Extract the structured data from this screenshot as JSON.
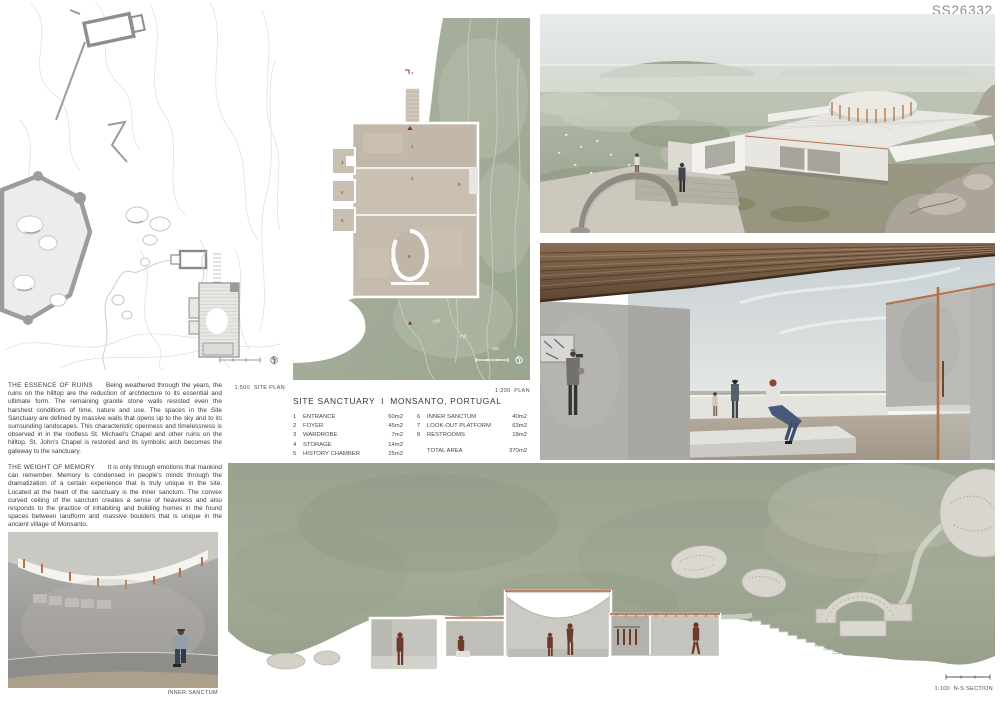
{
  "board_id": "SS26332",
  "title": "SITE SANCTUARY  I  MONSANTO, PORTUGAL",
  "theme": {
    "sage": "#a9b2a0",
    "sage-deep": "#97a18b",
    "stone-tan": "#c9c0b2",
    "concrete": "#b3b1ae",
    "wood": "#7d6147",
    "copper": "#b5714a",
    "figure-red": "#6e3a2c",
    "contour-gray": "#dedede",
    "caption-gray": "#4f4f4f"
  },
  "captions": {
    "site_plan": "1:500  SITE PLAN",
    "plan": "1:200  PLAN",
    "inner_sanctum": "INNER SANCTUM",
    "section": "1:100  N-S SECTION"
  },
  "essays": [
    {
      "heading": "THE ESSENCE OF RUINS",
      "body": "Being weathered through the years, the ruins on the hilltop are the reduction of architecture to its essential and ultimate form. The remaining granite stone walls resisted even the harshest conditions of time, nature and use.      The spaces in the Site Sanctuary are defined by massive walls that opens up to the sky and to its surrounding landscapes. This characteristic openness and timelessness is observed in in the roofless St. Michael's Chapel and other ruins on the hilltop. St. John's Chapel is restored and its symbolic arch becomes the gateway to the sanctuary."
    },
    {
      "heading": "THE WEIGHT OF MEMORY",
      "body": "It is only through emotions that mankind can remember. Memory is condensed in people's minds through the dramatization of a certain experience that is truly unique in the site. Located at the heart of the sanctuary is the inner sanctum. The convex curved ceiling of the sanctum creates a sense of heaviness and also responds to the practice of inhabiting and building homes in the found spaces between landform and massive boulders that is unique in the ancient village of Monsanto."
    }
  ],
  "program": {
    "left": [
      {
        "num": "1",
        "name": "ENTRANCE",
        "area": "60m2"
      },
      {
        "num": "2",
        "name": "FOYER",
        "area": "45m2"
      },
      {
        "num": "3",
        "name": "WARDROBE",
        "area": "7m2"
      },
      {
        "num": "4",
        "name": "STORAGE",
        "area": "14m2"
      },
      {
        "num": "5",
        "name": "HISTORY CHAMBER",
        "area": "25m2"
      }
    ],
    "right": [
      {
        "num": "6",
        "name": "INNER SANCTUM",
        "area": "40m2"
      },
      {
        "num": "7",
        "name": "LOOK-OUT PLATFORM",
        "area": "63m2"
      },
      {
        "num": "8",
        "name": "RESTROOMS",
        "area": "18m2"
      }
    ],
    "total_label": "TOTAL AREA",
    "total_value": "370m2"
  },
  "plan_annotations": {
    "contours": [
      "715",
      "710",
      "705"
    ],
    "rooms": [
      "1",
      "2",
      "3",
      "4",
      "5",
      "6",
      "7",
      "8"
    ]
  }
}
